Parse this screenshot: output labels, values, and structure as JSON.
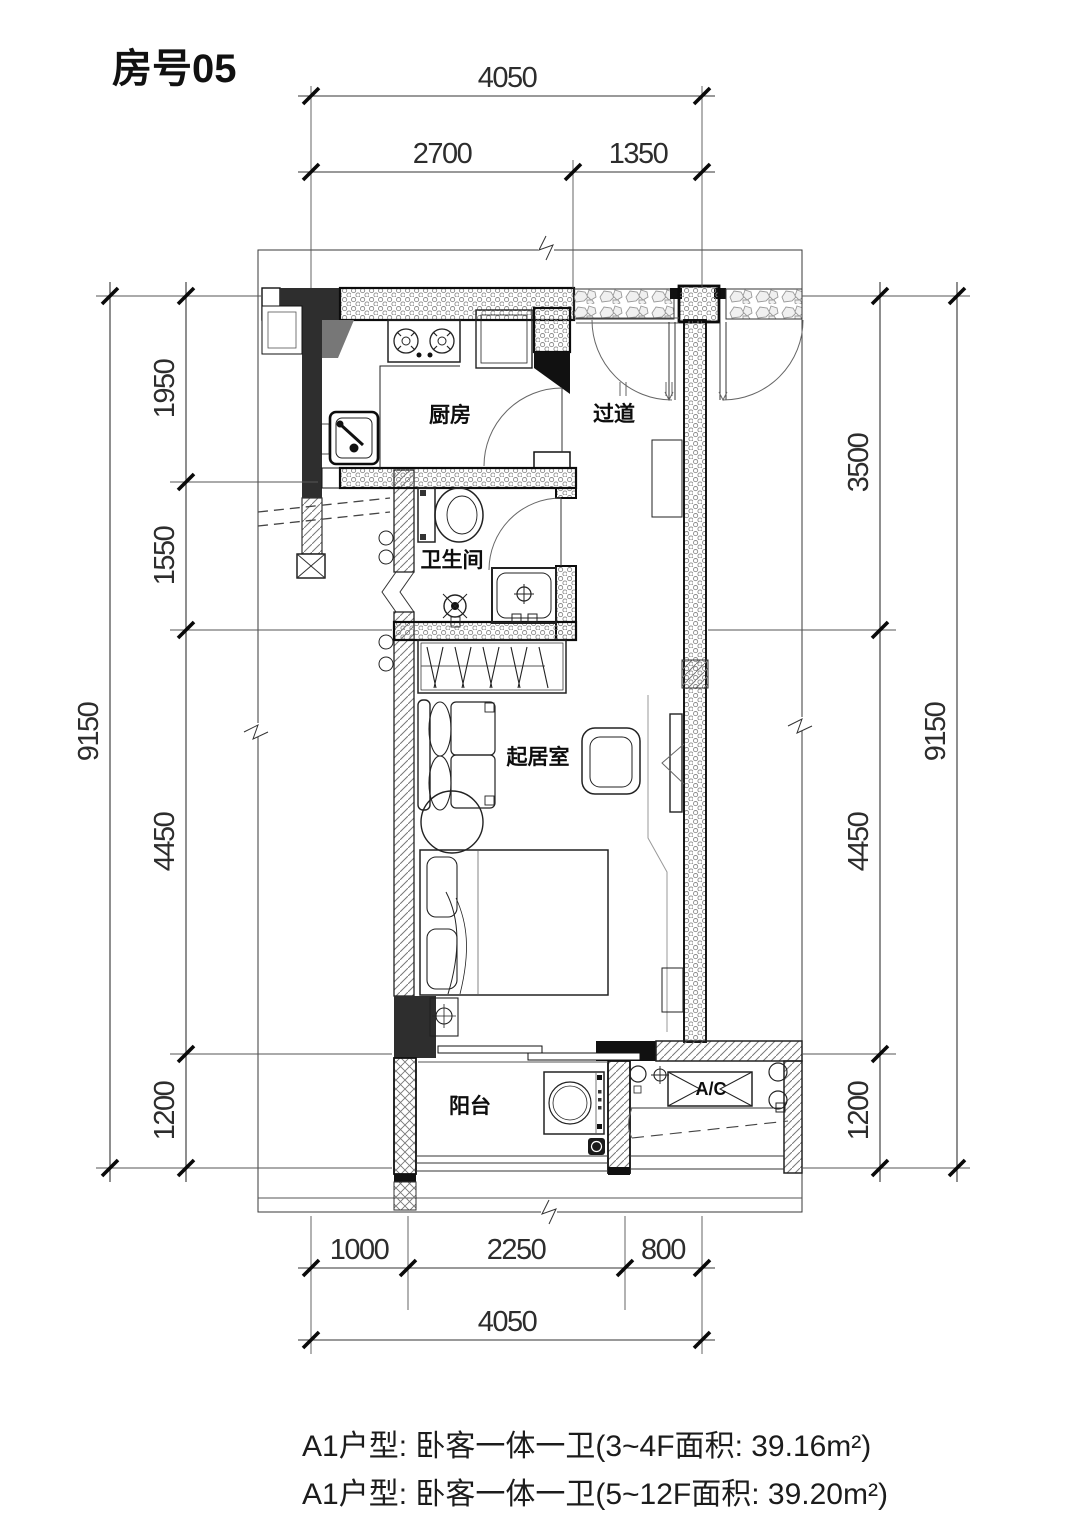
{
  "title": "房号05",
  "rooms": {
    "kitchen": "厨房",
    "hallway": "过道",
    "bathroom": "卫生间",
    "living_room": "起居室",
    "balcony": "阳台",
    "ac_platform": "A/C"
  },
  "dimensions": {
    "top": {
      "overall": "4050",
      "segments": [
        "2700",
        "1350"
      ]
    },
    "bottom": {
      "overall": "4050",
      "segments": [
        "1000",
        "2250",
        "800"
      ]
    },
    "left": {
      "overall": "9150",
      "segments": [
        "1950",
        "1550",
        "4450",
        "1200"
      ]
    },
    "right": {
      "overall": "9150",
      "segments": [
        "3500",
        "4450",
        "1200"
      ]
    }
  },
  "captions": [
    "A1户型: 卧客一体一卫(3~4F面积: 39.16m²)",
    "A1户型: 卧客一体一卫(5~12F面积: 39.20m²)"
  ],
  "colors": {
    "line": "#1f1f1f",
    "dark_fill": "#2e2e2e",
    "background": "#ffffff"
  }
}
